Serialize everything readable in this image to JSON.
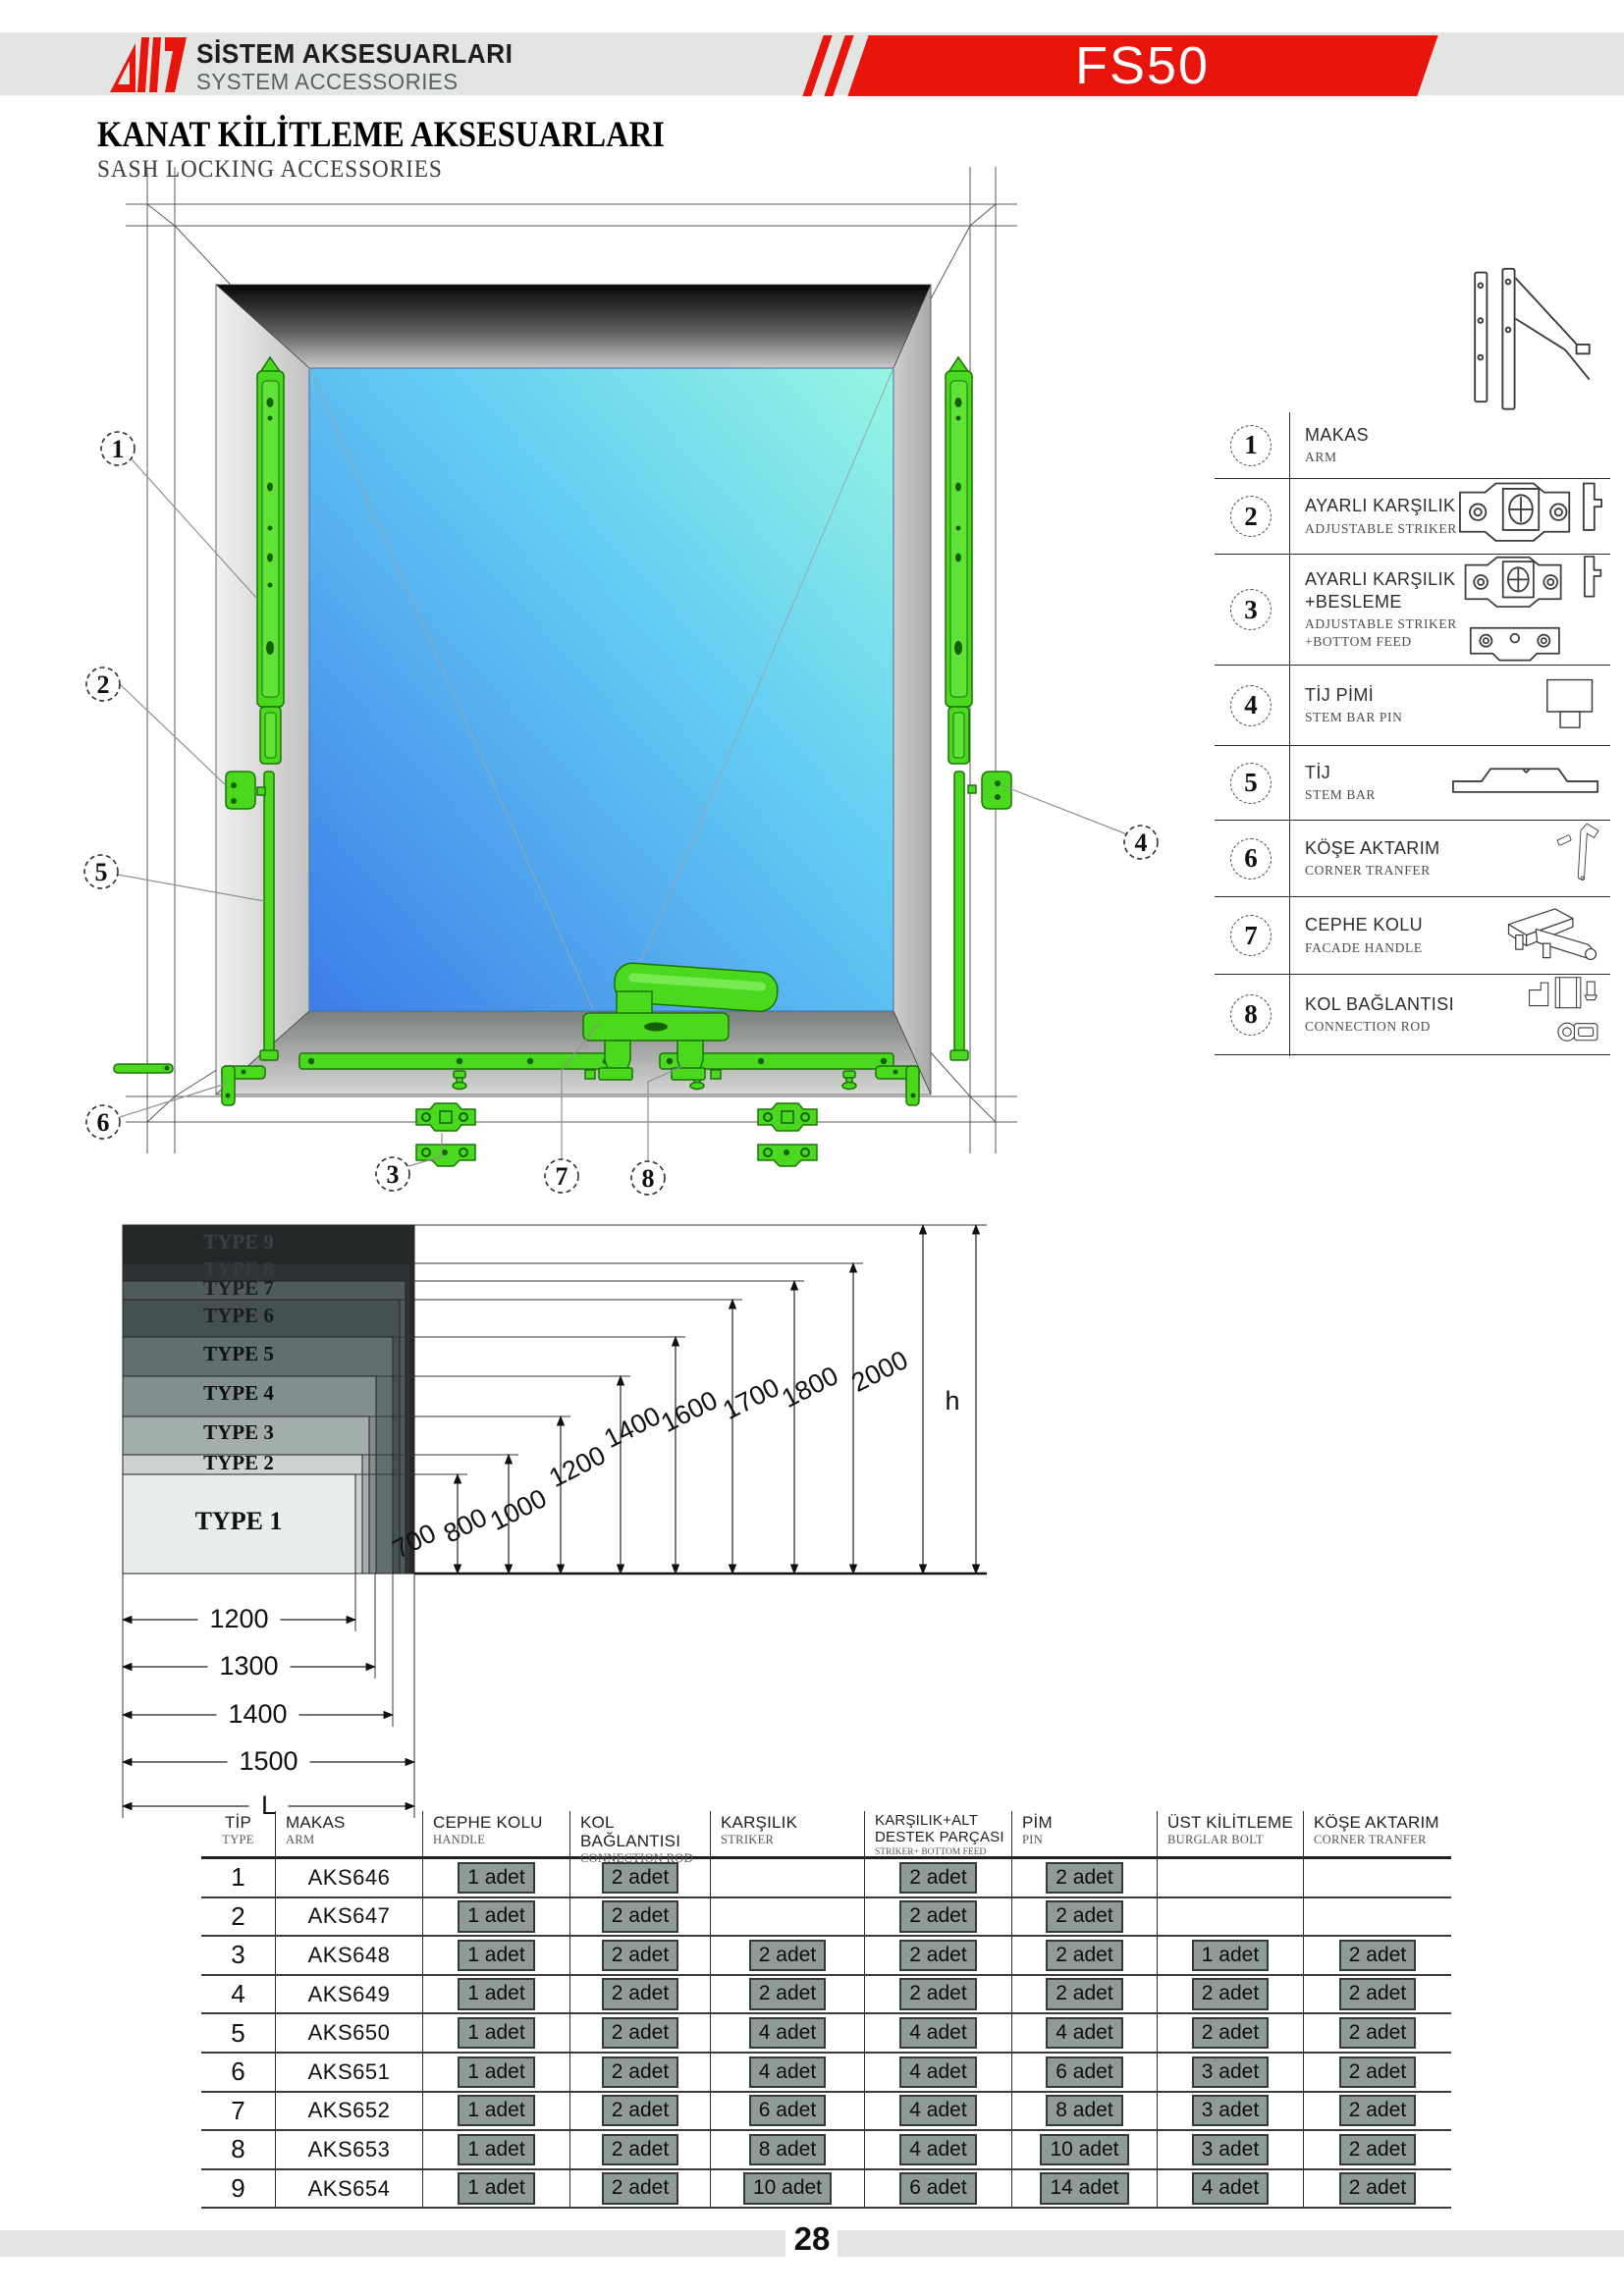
{
  "header": {
    "brand_title": "SİSTEM AKSESUARLARI",
    "brand_subtitle": "SYSTEM ACCESSORIES",
    "product_code": "FS50"
  },
  "title": {
    "tr": "KANAT KİLİTLEME AKSESUARLARI",
    "en": "SASH LOCKING ACCESSORIES"
  },
  "drawing": {
    "callouts": [
      {
        "num": "1"
      },
      {
        "num": "2"
      },
      {
        "num": "3"
      },
      {
        "num": "4"
      },
      {
        "num": "5"
      },
      {
        "num": "6"
      },
      {
        "num": "7"
      },
      {
        "num": "8"
      }
    ]
  },
  "legend": {
    "items": [
      {
        "num": "1",
        "tr": "MAKAS",
        "en": "ARM",
        "icon": "arm-icon"
      },
      {
        "num": "2",
        "tr": "AYARLI KARŞILIK",
        "en": "ADJUSTABLE STRIKER",
        "icon": "adjustable-striker-icon"
      },
      {
        "num": "3",
        "tr": "AYARLI KARŞILIK\n+BESLEME",
        "en": "ADJUSTABLE STRIKER\n+BOTTOM FEED",
        "icon": "adjustable-striker-bottom-feed-icon"
      },
      {
        "num": "4",
        "tr": "TİJ PİMİ",
        "en": "STEM BAR PIN",
        "icon": "stem-bar-pin-icon"
      },
      {
        "num": "5",
        "tr": "TİJ",
        "en": "STEM BAR",
        "icon": "stem-bar-icon"
      },
      {
        "num": "6",
        "tr": "KÖŞE AKTARIM",
        "en": "CORNER TRANFER",
        "icon": "corner-transfer-icon"
      },
      {
        "num": "7",
        "tr": "CEPHE KOLU",
        "en": "FACADE HANDLE",
        "icon": "facade-handle-icon"
      },
      {
        "num": "8",
        "tr": "KOL BAĞLANTISI",
        "en": "CONNECTION ROD",
        "icon": "connection-rod-icon"
      }
    ]
  },
  "type_diagram": {
    "types": [
      {
        "label": "TYPE 1",
        "height_mm": 700,
        "length_mm": 1200
      },
      {
        "label": "TYPE 2",
        "height_mm": 800,
        "length_mm": 1200
      },
      {
        "label": "TYPE 3",
        "height_mm": 1000,
        "length_mm": 1300
      },
      {
        "label": "TYPE 4",
        "height_mm": 1200,
        "length_mm": 1300
      },
      {
        "label": "TYPE 5",
        "height_mm": 1400,
        "length_mm": 1400
      },
      {
        "label": "TYPE 6",
        "height_mm": 1600,
        "length_mm": 1500
      },
      {
        "label": "TYPE 7",
        "height_mm": 1700,
        "length_mm": 1500
      },
      {
        "label": "TYPE 8",
        "height_mm": 1800,
        "length_mm": 1500
      },
      {
        "label": "TYPE 9",
        "height_mm": 2000,
        "length_mm": 1500
      }
    ],
    "height_ticks": [
      700,
      800,
      1000,
      1200,
      1400,
      1600,
      1700,
      1800,
      2000
    ],
    "length_ticks": [
      1200,
      1300,
      1400,
      1500
    ],
    "height_axis_label": "h",
    "length_axis_label": "L"
  },
  "table": {
    "columns": [
      {
        "tr": "TİP",
        "en": "TYPE"
      },
      {
        "tr": "MAKAS",
        "en": "ARM"
      },
      {
        "tr": "CEPHE KOLU",
        "en": "HANDLE"
      },
      {
        "tr": "KOL BAĞLANTISI",
        "en": "CONNECTION ROD"
      },
      {
        "tr": "KARŞILIK",
        "en": "STRIKER"
      },
      {
        "tr": "KARŞILIK+ALT\nDESTEK PARÇASI",
        "en": "STRIKER+ BOTTOM FEED"
      },
      {
        "tr": "PİM",
        "en": "PIN"
      },
      {
        "tr": "ÜST KİLİTLEME",
        "en": "BURGLAR BOLT"
      },
      {
        "tr": "KÖŞE AKTARIM",
        "en": "CORNER TRANFER"
      }
    ],
    "rows": [
      {
        "type": "1",
        "arm": "AKS646",
        "qty": [
          "1 adet",
          "2 adet",
          "",
          "2 adet",
          "2 adet",
          "",
          ""
        ]
      },
      {
        "type": "2",
        "arm": "AKS647",
        "qty": [
          "1 adet",
          "2 adet",
          "",
          "2 adet",
          "2 adet",
          "",
          ""
        ]
      },
      {
        "type": "3",
        "arm": "AKS648",
        "qty": [
          "1 adet",
          "2 adet",
          "2 adet",
          "2 adet",
          "2 adet",
          "1 adet",
          "2 adet"
        ]
      },
      {
        "type": "4",
        "arm": "AKS649",
        "qty": [
          "1 adet",
          "2 adet",
          "2 adet",
          "2 adet",
          "2 adet",
          "2 adet",
          "2 adet"
        ]
      },
      {
        "type": "5",
        "arm": "AKS650",
        "qty": [
          "1 adet",
          "2 adet",
          "4 adet",
          "4 adet",
          "4 adet",
          "2 adet",
          "2 adet"
        ]
      },
      {
        "type": "6",
        "arm": "AKS651",
        "qty": [
          "1 adet",
          "2 adet",
          "4 adet",
          "4 adet",
          "6 adet",
          "3 adet",
          "2 adet"
        ]
      },
      {
        "type": "7",
        "arm": "AKS652",
        "qty": [
          "1 adet",
          "2 adet",
          "6 adet",
          "4 adet",
          "8 adet",
          "3 adet",
          "2 adet"
        ]
      },
      {
        "type": "8",
        "arm": "AKS653",
        "qty": [
          "1 adet",
          "2 adet",
          "8 adet",
          "4 adet",
          "10 adet",
          "3 adet",
          "2 adet"
        ]
      },
      {
        "type": "9",
        "arm": "AKS654",
        "qty": [
          "1 adet",
          "2 adet",
          "10 adet",
          "6 adet",
          "14 adet",
          "4 adet",
          "2 adet"
        ]
      }
    ]
  },
  "footer": {
    "page_number": "28"
  },
  "colors": {
    "accent_red": "#e8150d",
    "header_bar_gray": "#e3e5e2",
    "hardware_green": "#4bd91f",
    "qty_box_bg": "#8e9b97",
    "qty_box_border": "#333a37",
    "glass_top_right": "#96f6e2",
    "glass_bottom_left": "#3d7ce8",
    "type_block_lightest": "#e9edec",
    "type_block_darkest": "#242829"
  }
}
